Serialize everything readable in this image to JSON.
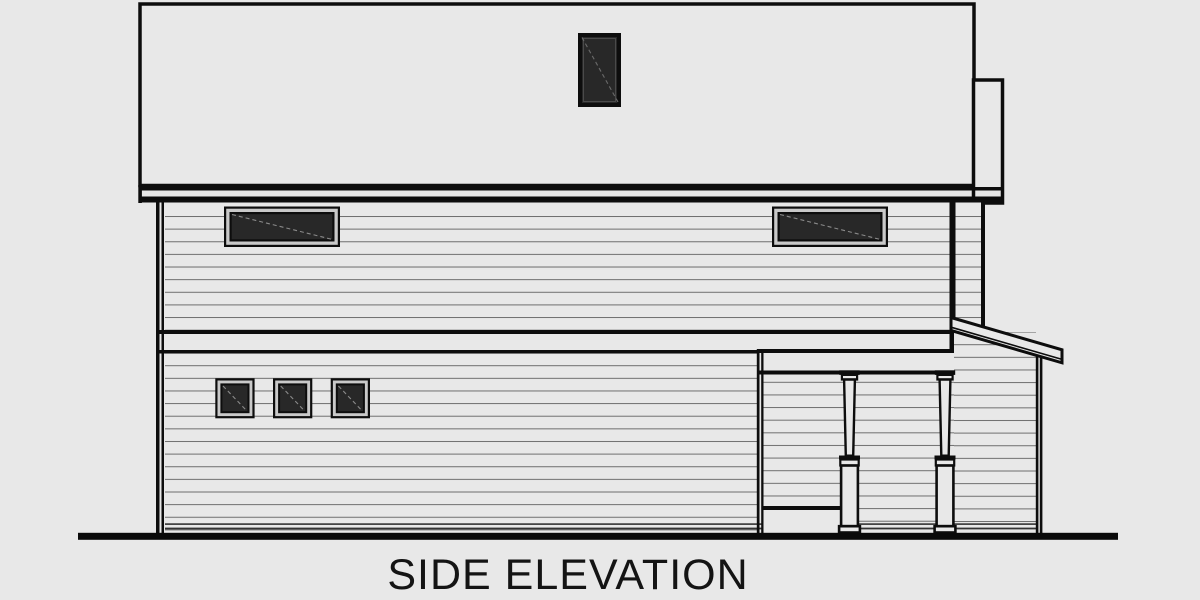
{
  "title": "SIDE ELEVATION",
  "colors": {
    "background": "#e8e8e8",
    "ink": "#0d0d0d",
    "siding-line": "#6e6e6e",
    "window-pane": "#282828",
    "window-mat": "#c9c9c9",
    "detail-line": "#333333",
    "ground": "#0a0a0a",
    "title-text": "#141414"
  }
}
